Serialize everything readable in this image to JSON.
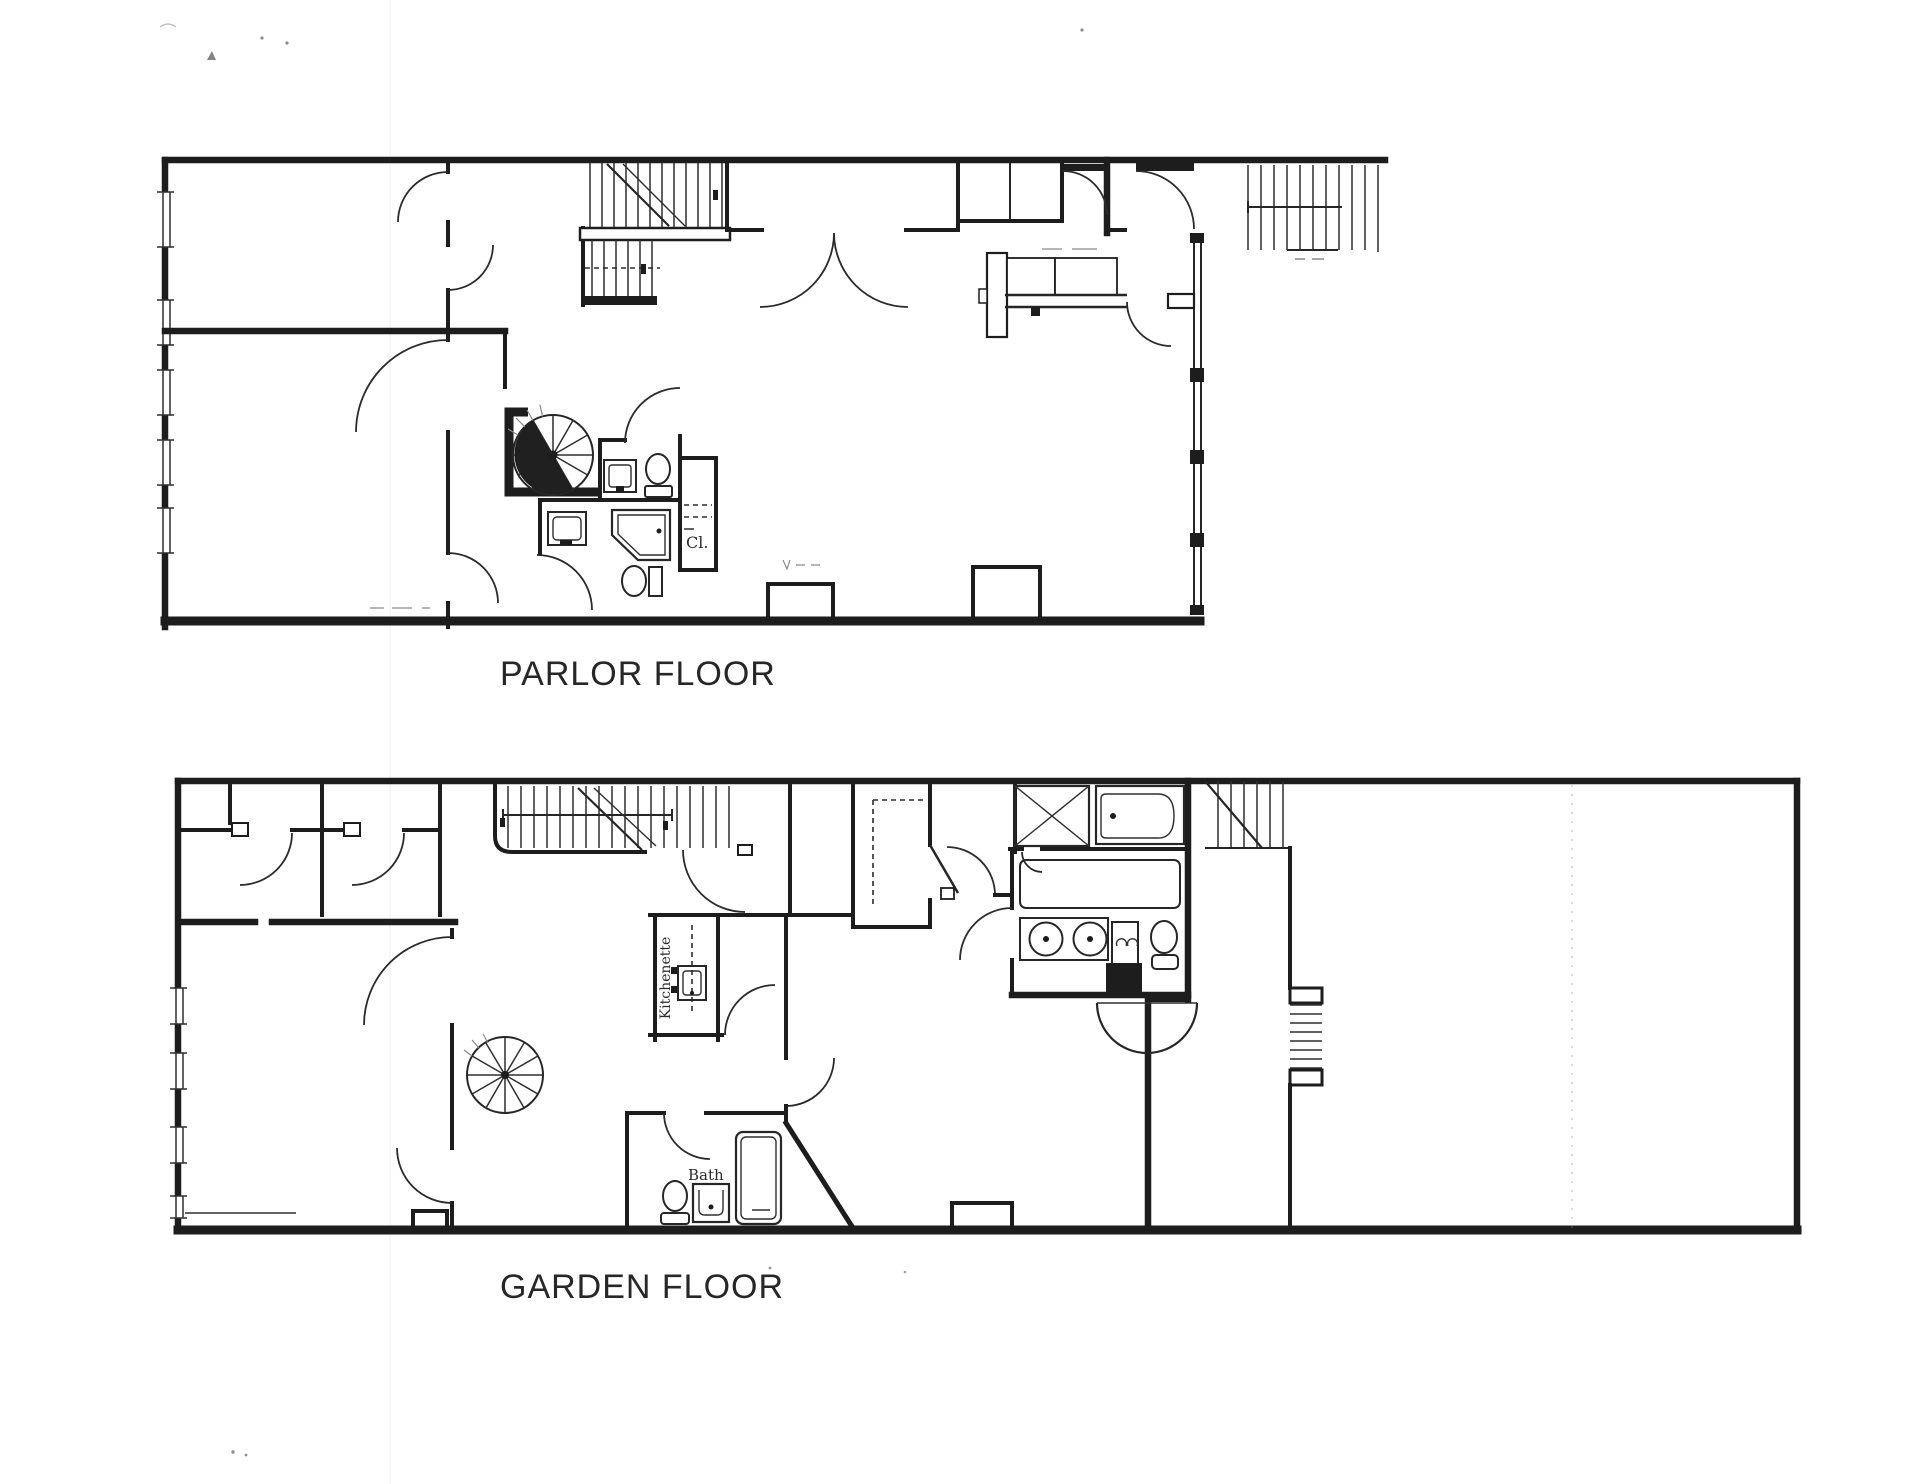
{
  "background": "#ffffff",
  "ink": "#1f1f1f",
  "floors": [
    {
      "title": "PARLOR FLOOR",
      "annotations": {
        "closet": "Cl."
      }
    },
    {
      "title": "GARDEN FLOOR",
      "annotations": {
        "kitchenette": "Kitchenette",
        "bath": "Bath"
      }
    }
  ]
}
